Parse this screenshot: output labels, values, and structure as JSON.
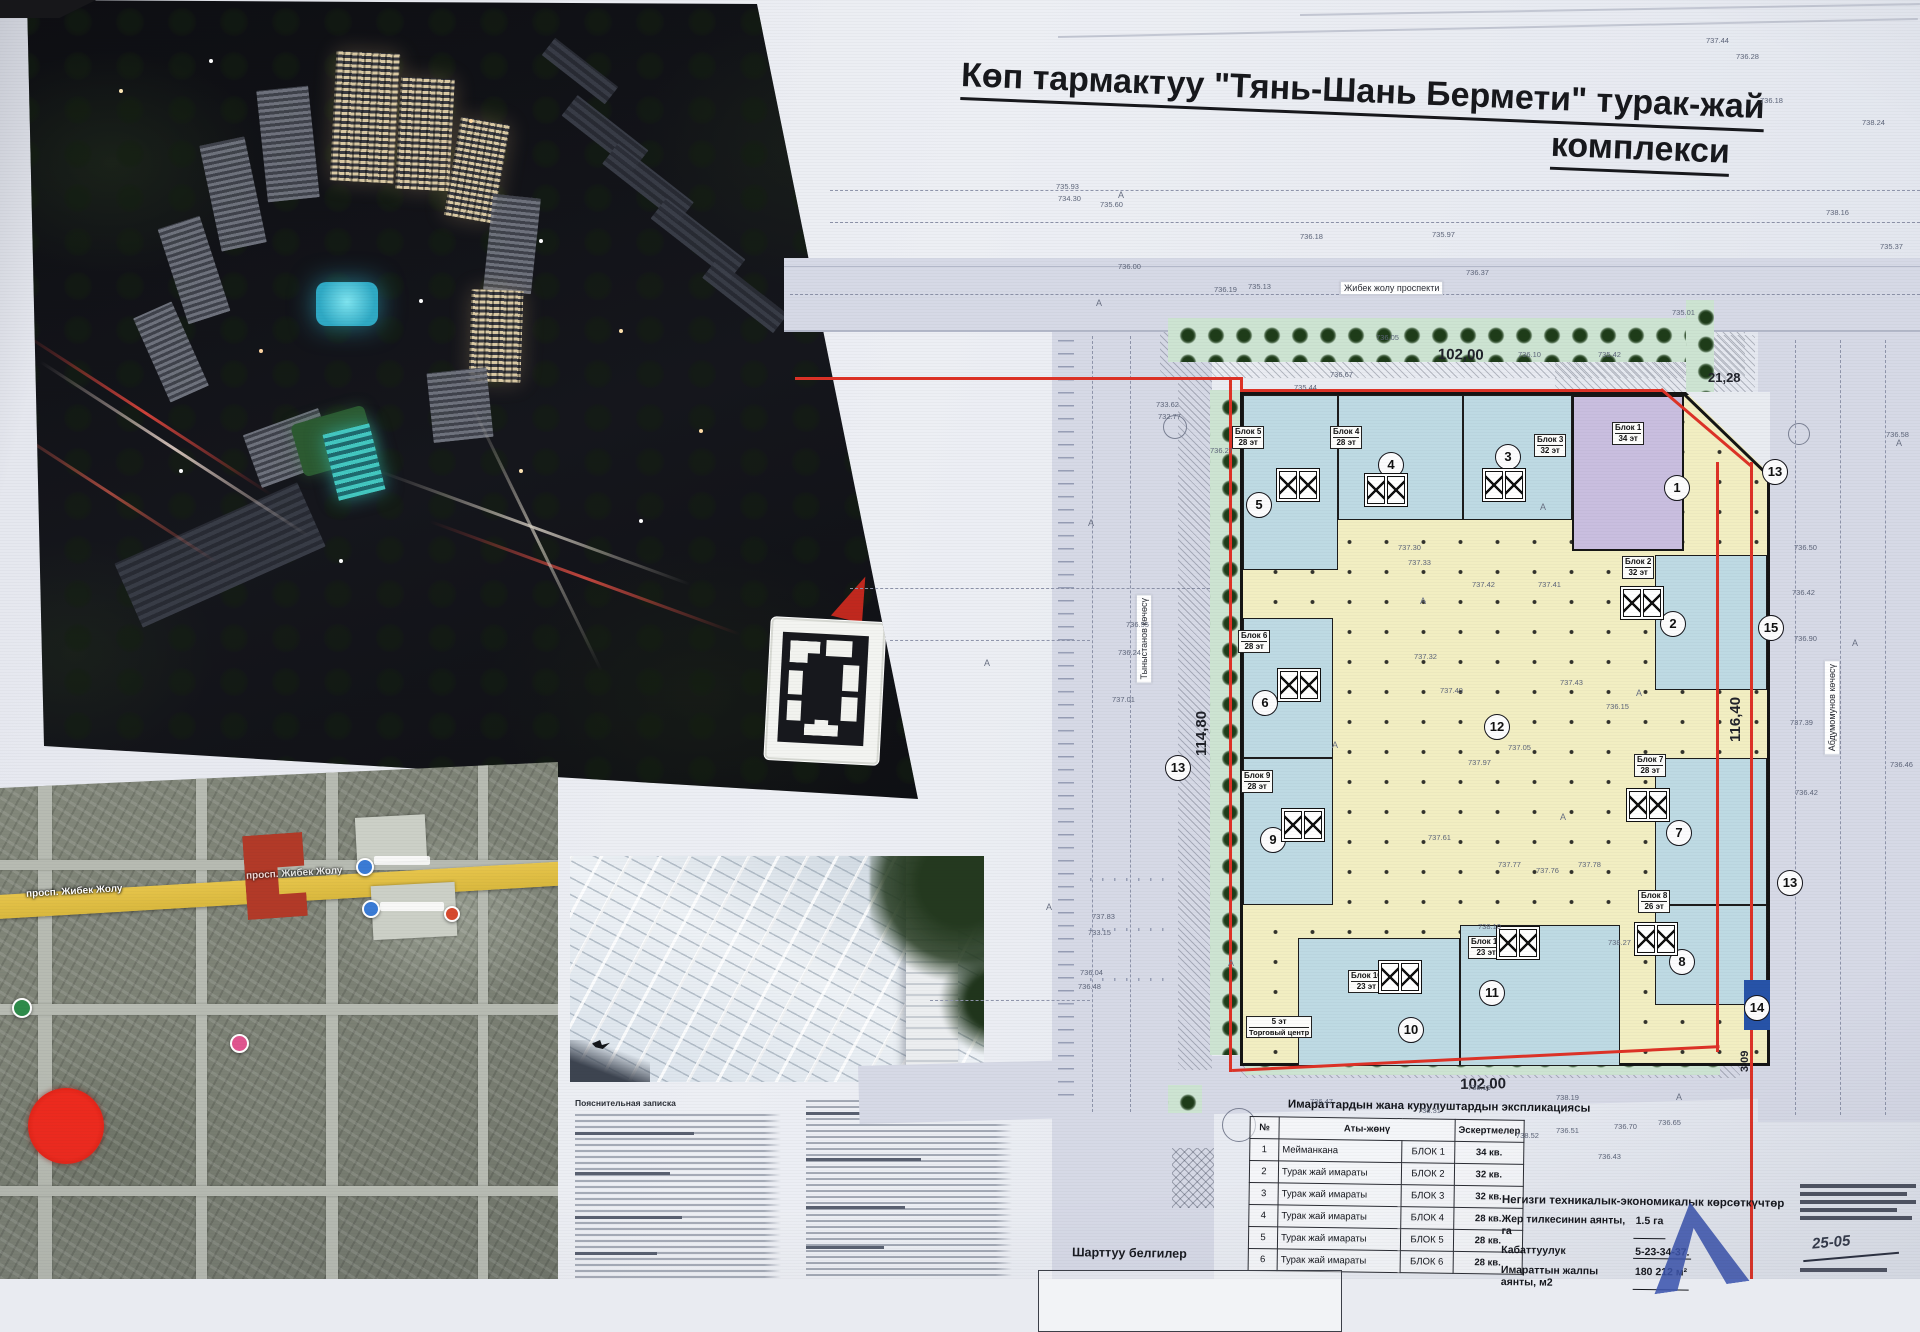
{
  "title": {
    "line1": "Көп тармактуу \"Тянь-Шань Бермети\" турак-жай",
    "line2": "комплекси"
  },
  "map": {
    "road_label1": "просп. Жибек Жолу",
    "road_label2": "просп. Жибек Жолу"
  },
  "notes": {
    "heading": "Пояснительная записка"
  },
  "plan": {
    "streets": {
      "top": "Жибек жолу проспекти",
      "left": "Тыныстанов көчөсү",
      "right": "Абдумомунов көчөсү"
    },
    "shop_label": {
      "l1": "5 эт",
      "l2": "Торговый центр"
    },
    "dimensions": [
      {
        "v": "102,00",
        "x": 1438,
        "y": 346,
        "rot": 1,
        "fs": 15
      },
      {
        "v": "21,28",
        "x": 1708,
        "y": 370,
        "rot": 0,
        "fs": 13
      },
      {
        "v": "114,80",
        "x": 1193,
        "y": 756,
        "rot": -90,
        "fs": 15
      },
      {
        "v": "116,40",
        "x": 1727,
        "y": 742,
        "rot": -90,
        "fs": 15
      },
      {
        "v": "3,09",
        "x": 1739,
        "y": 1072,
        "rot": -90,
        "fs": 11
      },
      {
        "v": "102,00",
        "x": 1460,
        "y": 1076,
        "rot": -1,
        "fs": 15
      }
    ],
    "circles": [
      {
        "n": "5",
        "x": 1259,
        "y": 505
      },
      {
        "n": "4",
        "x": 1391,
        "y": 465
      },
      {
        "n": "3",
        "x": 1508,
        "y": 457
      },
      {
        "n": "1",
        "x": 1677,
        "y": 488
      },
      {
        "n": "2",
        "x": 1673,
        "y": 624
      },
      {
        "n": "12",
        "x": 1497,
        "y": 727
      },
      {
        "n": "6",
        "x": 1265,
        "y": 703
      },
      {
        "n": "9",
        "x": 1273,
        "y": 840
      },
      {
        "n": "7",
        "x": 1679,
        "y": 833
      },
      {
        "n": "8",
        "x": 1682,
        "y": 962
      },
      {
        "n": "11",
        "x": 1492,
        "y": 993
      },
      {
        "n": "10",
        "x": 1411,
        "y": 1030
      },
      {
        "n": "13",
        "x": 1178,
        "y": 768
      },
      {
        "n": "13",
        "x": 1775,
        "y": 472
      },
      {
        "n": "13",
        "x": 1790,
        "y": 883
      },
      {
        "n": "15",
        "x": 1771,
        "y": 628
      },
      {
        "n": "14",
        "x": 1757,
        "y": 1008
      }
    ],
    "block_labels": [
      {
        "t": "Блок 5",
        "s": "28 эт",
        "x": 1232,
        "y": 426
      },
      {
        "t": "Блок 4",
        "s": "28 эт",
        "x": 1330,
        "y": 426
      },
      {
        "t": "Блок 3",
        "s": "32 эт",
        "x": 1534,
        "y": 434
      },
      {
        "t": "Блок 1",
        "s": "34 эт",
        "x": 1612,
        "y": 422
      },
      {
        "t": "Блок 2",
        "s": "32 эт",
        "x": 1622,
        "y": 556
      },
      {
        "t": "Блок 6",
        "s": "28 эт",
        "x": 1238,
        "y": 630
      },
      {
        "t": "Блок 9",
        "s": "28 эт",
        "x": 1241,
        "y": 770
      },
      {
        "t": "Блок 7",
        "s": "28 эт",
        "x": 1634,
        "y": 754
      },
      {
        "t": "Блок 8",
        "s": "26 эт",
        "x": 1638,
        "y": 890
      },
      {
        "t": "Блок 10",
        "s": "23 эт",
        "x": 1348,
        "y": 970
      },
      {
        "t": "Блок 11",
        "s": "23 эт",
        "x": 1468,
        "y": 936
      }
    ],
    "cores": [
      {
        "x": 1276,
        "y": 468
      },
      {
        "x": 1364,
        "y": 473
      },
      {
        "x": 1482,
        "y": 468
      },
      {
        "x": 1620,
        "y": 586
      },
      {
        "x": 1277,
        "y": 668
      },
      {
        "x": 1281,
        "y": 808
      },
      {
        "x": 1626,
        "y": 788
      },
      {
        "x": 1634,
        "y": 922
      },
      {
        "x": 1378,
        "y": 960
      },
      {
        "x": 1496,
        "y": 926
      }
    ],
    "elevations": [
      {
        "v": "735.93",
        "x": 1056,
        "y": 182
      },
      {
        "v": "734.30",
        "x": 1058,
        "y": 194
      },
      {
        "v": "735.60",
        "x": 1100,
        "y": 200
      },
      {
        "v": "736.00",
        "x": 1118,
        "y": 262
      },
      {
        "v": "736.18",
        "x": 1300,
        "y": 232
      },
      {
        "v": "735.97",
        "x": 1432,
        "y": 230
      },
      {
        "v": "736.19",
        "x": 1214,
        "y": 285
      },
      {
        "v": "735.13",
        "x": 1248,
        "y": 282
      },
      {
        "v": "736.37",
        "x": 1466,
        "y": 268
      },
      {
        "v": "736.05",
        "x": 1376,
        "y": 333
      },
      {
        "v": "735.44",
        "x": 1294,
        "y": 383
      },
      {
        "v": "736.67",
        "x": 1330,
        "y": 370
      },
      {
        "v": "736.10",
        "x": 1518,
        "y": 350
      },
      {
        "v": "735.42",
        "x": 1598,
        "y": 350
      },
      {
        "v": "735.01",
        "x": 1672,
        "y": 308
      },
      {
        "v": "736.27",
        "x": 1210,
        "y": 446
      },
      {
        "v": "733.62",
        "x": 1156,
        "y": 400
      },
      {
        "v": "732.77",
        "x": 1158,
        "y": 412
      },
      {
        "v": "736.55",
        "x": 1126,
        "y": 620
      },
      {
        "v": "736.24",
        "x": 1118,
        "y": 648
      },
      {
        "v": "737.01",
        "x": 1112,
        "y": 695
      },
      {
        "v": "737.33",
        "x": 1408,
        "y": 558
      },
      {
        "v": "737.42",
        "x": 1472,
        "y": 580
      },
      {
        "v": "737.41",
        "x": 1538,
        "y": 580
      },
      {
        "v": "737.30",
        "x": 1398,
        "y": 543
      },
      {
        "v": "737.32",
        "x": 1414,
        "y": 652
      },
      {
        "v": "737.49",
        "x": 1440,
        "y": 686
      },
      {
        "v": "737.97",
        "x": 1468,
        "y": 758
      },
      {
        "v": "737.05",
        "x": 1508,
        "y": 743
      },
      {
        "v": "737.43",
        "x": 1560,
        "y": 678
      },
      {
        "v": "736.15",
        "x": 1606,
        "y": 702
      },
      {
        "v": "737.61",
        "x": 1428,
        "y": 833
      },
      {
        "v": "737.77",
        "x": 1498,
        "y": 860
      },
      {
        "v": "737.76",
        "x": 1536,
        "y": 866
      },
      {
        "v": "737.78",
        "x": 1578,
        "y": 860
      },
      {
        "v": "738.27",
        "x": 1608,
        "y": 938
      },
      {
        "v": "738.10",
        "x": 1478,
        "y": 922
      },
      {
        "v": "737.83",
        "x": 1092,
        "y": 912
      },
      {
        "v": "733.15",
        "x": 1088,
        "y": 928
      },
      {
        "v": "736.04",
        "x": 1080,
        "y": 968
      },
      {
        "v": "736.48",
        "x": 1078,
        "y": 982
      },
      {
        "v": "738.19",
        "x": 1468,
        "y": 1083
      },
      {
        "v": "738.31",
        "x": 1418,
        "y": 1106
      },
      {
        "v": "738.19",
        "x": 1556,
        "y": 1093
      },
      {
        "v": "736.47",
        "x": 1310,
        "y": 1097
      },
      {
        "v": "736.50",
        "x": 1794,
        "y": 543
      },
      {
        "v": "736.42",
        "x": 1792,
        "y": 588
      },
      {
        "v": "736.90",
        "x": 1794,
        "y": 634
      },
      {
        "v": "737.39",
        "x": 1790,
        "y": 718
      },
      {
        "v": "736.42",
        "x": 1795,
        "y": 788
      },
      {
        "v": "738.52",
        "x": 1516,
        "y": 1131
      },
      {
        "v": "736.51",
        "x": 1556,
        "y": 1126
      },
      {
        "v": "736.70",
        "x": 1614,
        "y": 1122
      },
      {
        "v": "736.65",
        "x": 1658,
        "y": 1118
      },
      {
        "v": "736.43",
        "x": 1598,
        "y": 1152
      },
      {
        "v": "738.24",
        "x": 1862,
        "y": 118
      },
      {
        "v": "736.18",
        "x": 1760,
        "y": 96
      },
      {
        "v": "737.44",
        "x": 1706,
        "y": 36
      },
      {
        "v": "736.28",
        "x": 1736,
        "y": 52
      },
      {
        "v": "738.16",
        "x": 1826,
        "y": 208
      },
      {
        "v": "735.37",
        "x": 1880,
        "y": 242
      },
      {
        "v": "736.58",
        "x": 1886,
        "y": 430
      },
      {
        "v": "736.46",
        "x": 1890,
        "y": 760
      }
    ],
    "marks": [
      {
        "x": 1096,
        "y": 298
      },
      {
        "x": 984,
        "y": 658
      },
      {
        "x": 1088,
        "y": 518
      },
      {
        "x": 1046,
        "y": 902
      },
      {
        "x": 1420,
        "y": 596
      },
      {
        "x": 1636,
        "y": 688
      },
      {
        "x": 1540,
        "y": 502
      },
      {
        "x": 1228,
        "y": 958
      },
      {
        "x": 1676,
        "y": 1092
      },
      {
        "x": 1852,
        "y": 638
      },
      {
        "x": 1896,
        "y": 438
      },
      {
        "x": 1332,
        "y": 740
      },
      {
        "x": 1560,
        "y": 812
      },
      {
        "x": 1118,
        "y": 190
      }
    ],
    "table": {
      "title": "Имараттардын жана курулуштардын экспликациясы",
      "col_no": "№",
      "col_name": "Аты-жөнү",
      "col_note": "Эскертмелер",
      "rows": [
        {
          "no": "1",
          "name": "Мейманкана",
          "blok": "БЛОК 1",
          "note": "34 кв."
        },
        {
          "no": "2",
          "name": "Турак жай имараты",
          "blok": "БЛОК 2",
          "note": "32 кв."
        },
        {
          "no": "3",
          "name": "Турак жай имараты",
          "blok": "БЛОК 3",
          "note": "32 кв."
        },
        {
          "no": "4",
          "name": "Турак жай имараты",
          "blok": "БЛОК 4",
          "note": "28 кв."
        },
        {
          "no": "5",
          "name": "Турак жай имараты",
          "blok": "БЛОК 5",
          "note": "28 кв."
        },
        {
          "no": "6",
          "name": "Турак жай имараты",
          "blok": "БЛОК 6",
          "note": "28 кв."
        }
      ]
    },
    "legend_title": "Шарттуу белгилер",
    "tech": {
      "title": "Негизги техникалык-экономикалык көрсөткүчтөр",
      "rows": [
        {
          "label": "Жер тилкесинин аянты, га",
          "value": "1.5 га"
        },
        {
          "label": "Кабаттуулук",
          "value": "5-23-34-37."
        },
        {
          "label": "Имараттын жалпы аянты, м2",
          "value": "180 212 м²"
        }
      ]
    },
    "stamp_date": "25-05"
  },
  "colors": {
    "boundary_red": "#dd3226",
    "courtyard_yellow": "#f2eec2",
    "tower_blue": "#bedae3",
    "hotel_purple": "#c9bedf",
    "green_strip": "#cde4d2",
    "street_lavender": "#d6d9e6",
    "stamp_blue": "#3c55ae"
  }
}
